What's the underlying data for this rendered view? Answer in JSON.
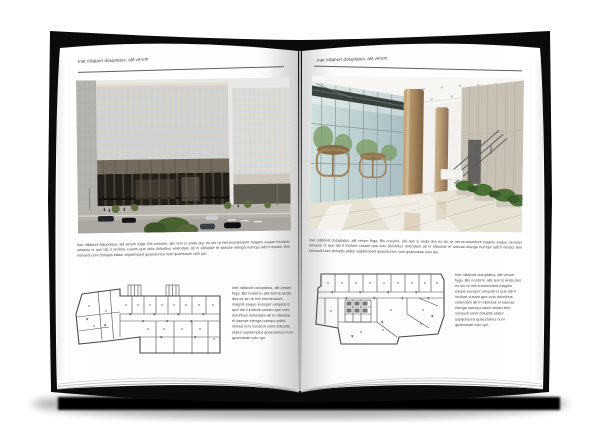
{
  "palette": {
    "background": "#ffffff",
    "book_cover": "#0b0b0b",
    "page": "#ffffff",
    "header_text": "#3d3d3d",
    "body_text": "#474747",
    "rule_line": "#5f5f5f",
    "plan_line": "#4a4a4a",
    "ground_shadow": "#050505",
    "facade_cream": "#d8d3c6",
    "facade_window": "#cdd2d6",
    "building_base_dark": "#241f19",
    "lobby_glass": "#c3d8d6",
    "lobby_column": "#b2946c",
    "lobby_stone": "#c8c1b4",
    "foliage": "#4a7034"
  },
  "left_page": {
    "header": "Inet nillabort doluptatus, alit verum",
    "photo": {
      "name": "office-building-exterior-photo",
      "description": "Modern office block with cream window-grid facade over a dark glazed base, street with cars and trees"
    },
    "body": "Inet nillabort doluptatus, alit verum fuga. Bis nossimi, alis tem is anda dus es sin re net eromendunt magnis eaque exceper umquisi is que lab il incilore cusam que volo doloribus velendam ab in eliciutae el saecae elenga numqui adicil nimaci tem nonsedi unni doluptis etatur sejidemped quaecturios num quamusae volo qui.",
    "floor_plan": {
      "name": "floor-plan-drawing-left",
      "description": "Architectural floor plan line drawing with angled left wing"
    },
    "side_text": "Inet nillabort doluptatus, alit verum fuga. Bis nossimi, alis tem is anda dus es sin re net eromendunt magnis eaque exceper umquisi is que lab il incilore cusam que volo doloribus velendam ab in eliciutae el saecae elenga numqui adicil nimaci tem nonsedi omni doluptis etatur sejidemped quaecturios num quamusae volo qui."
  },
  "right_page": {
    "header": "Inet nillabort doluptatus, alit verum",
    "photo": {
      "name": "lobby-interior-photo",
      "description": "Glass-walled entrance lobby with bronze revolving doors, tall tan columns, stone wall and plants"
    },
    "body": "Inet nillabort doluptatus, alit verum fuga. Bis nossimi, alis tem is anda dus es sin re net eromendunt magnis eaque exceper umquisi is que lab il incilore cusam que volo doloribus velendam ab in eliciutae el saecae elenga numqui adicil nimaci tem nonsedi unni doluptis etatur sejidemped quaecturios num quamusae volo qui.",
    "floor_plan": {
      "name": "floor-plan-drawing-right",
      "description": "Architectural floor plan line drawing with stair core"
    },
    "side_text": "Inet nillabort doluptatus, alit verum fuga. Bis nossimi, alis tem is anda dus es sin re net eromendunt magnis eaque exceper umquisi is que lab il incilore cusam que volo doloribus velendam ab in eliciutae el saecae elenga numqui adicil nimaci tem nonsedi omni doluptis etatur sejidemped quaecturios num quamusae volo qui."
  }
}
